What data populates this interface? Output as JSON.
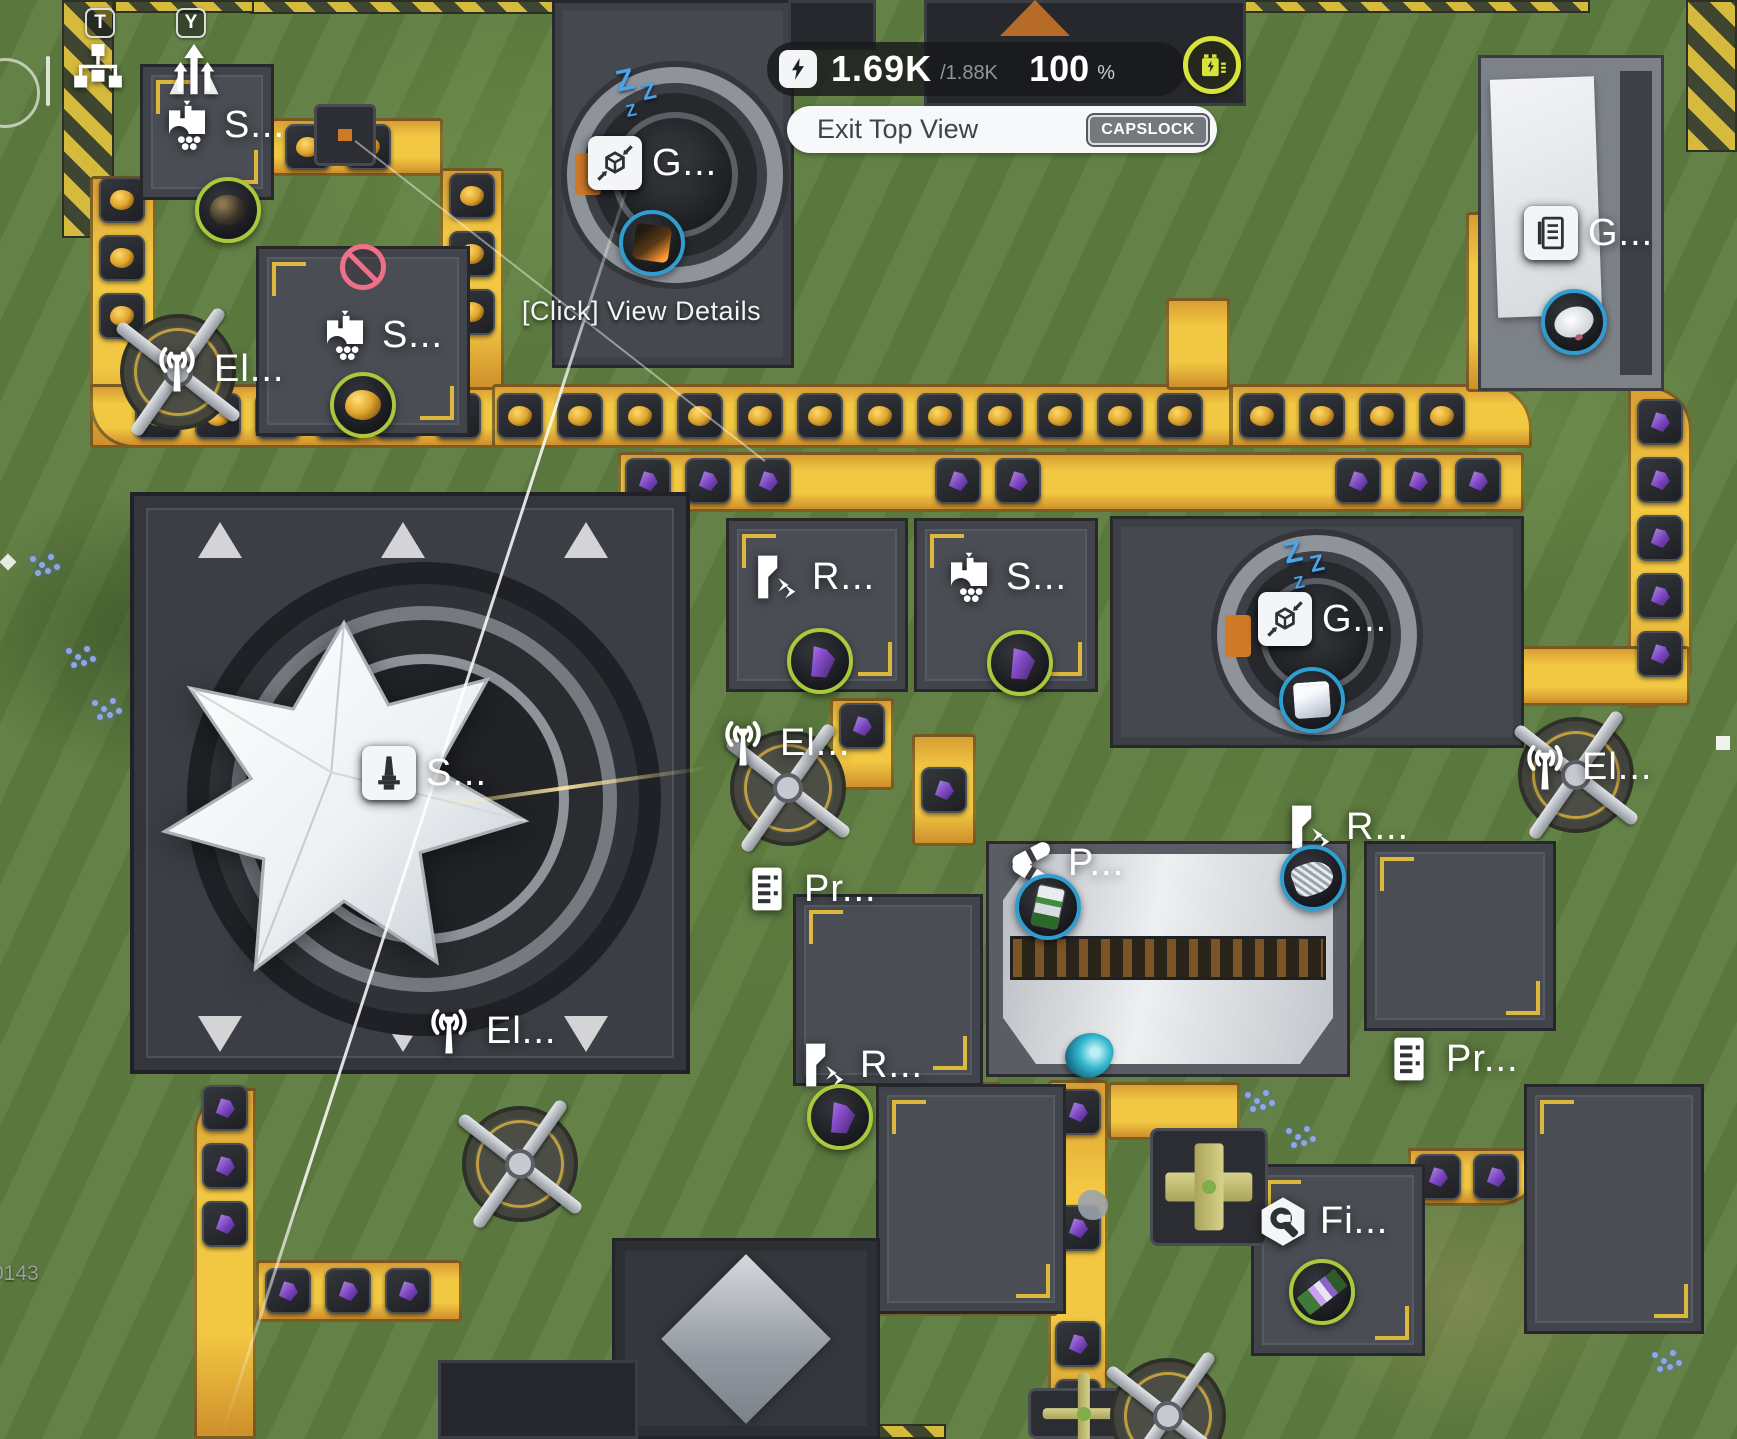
{
  "hud": {
    "keybinds": [
      {
        "key": "T",
        "icon": "org-chart-icon"
      },
      {
        "key": "Y",
        "icon": "ascend-icon"
      }
    ],
    "power": {
      "icon": "lightning-icon",
      "current": "1.69K",
      "capacity": "/1.88K",
      "percent": "100",
      "percent_symbol": "%",
      "battery_icon": "battery-icon",
      "accent_color": "#d8e43c"
    },
    "exit_button": {
      "label": "Exit Top View",
      "keybind": "CAPSLOCK"
    },
    "tooltip": "[Click] View Details",
    "version": "0143"
  },
  "colors": {
    "belt_yellow": "#f2c843",
    "ring_green": "#a9c83b",
    "ring_blue": "#2f9dd0",
    "sleep_blue": "#4aa5e8",
    "blocked_red": "#ef7088"
  },
  "buildings": [
    {
      "id": "storehouse-top-left",
      "label": "S...",
      "icon": "silo-icon",
      "lx": 160,
      "ly": 98,
      "item": {
        "name": "dark-ore",
        "ring": "green",
        "cx": 228,
        "cy": 210
      }
    },
    {
      "id": "storehouse-blocked",
      "label": "S...",
      "icon": "silo-icon",
      "lx": 318,
      "ly": 308,
      "blocked": {
        "cx": 363,
        "cy": 267
      },
      "item": {
        "name": "gold-ore",
        "ring": "green",
        "cx": 363,
        "cy": 405
      }
    },
    {
      "id": "pylon-left",
      "label": "El...",
      "icon": "antenna-icon",
      "lx": 150,
      "ly": 342
    },
    {
      "id": "grinder-top",
      "label": "G...",
      "icon": "compress-cube-icon",
      "lx": 588,
      "ly": 136,
      "sleep": {
        "x": 616,
        "y": 66
      },
      "item": {
        "name": "orange-cube",
        "ring": "blue",
        "cx": 652,
        "cy": 243
      }
    },
    {
      "id": "depot-top-right",
      "label": "G...",
      "icon": "document-icon",
      "lx": 1524,
      "ly": 206,
      "item": {
        "name": "dish",
        "ring": "blue",
        "cx": 1574,
        "cy": 322
      }
    },
    {
      "id": "refiner-mid",
      "label": "R...",
      "icon": "refinery-icon",
      "lx": 748,
      "ly": 550,
      "item": {
        "name": "purple-crystal",
        "ring": "green",
        "cx": 820,
        "cy": 661
      }
    },
    {
      "id": "storehouse-mid",
      "label": "S...",
      "icon": "silo-icon",
      "lx": 942,
      "ly": 550,
      "item": {
        "name": "purple-crystal",
        "ring": "green",
        "cx": 1020,
        "cy": 663
      }
    },
    {
      "id": "grinder-mid",
      "label": "G...",
      "icon": "compress-cube-icon",
      "lx": 1258,
      "ly": 592,
      "sleep": {
        "x": 1284,
        "y": 538
      },
      "item": {
        "name": "white-cube",
        "ring": "blue",
        "cx": 1312,
        "cy": 700
      }
    },
    {
      "id": "pylon-mid-left",
      "label": "El...",
      "icon": "antenna-icon",
      "lx": 716,
      "ly": 716
    },
    {
      "id": "pylon-mid-right",
      "label": "El...",
      "icon": "antenna-icon",
      "lx": 1518,
      "ly": 740
    },
    {
      "id": "spire",
      "label": "S...",
      "icon": "tower-icon",
      "lx": 362,
      "ly": 746
    },
    {
      "id": "processor-left",
      "label": "Pr...",
      "icon": "rack-icon",
      "lx": 740,
      "ly": 862
    },
    {
      "id": "packer-center",
      "label": "P...",
      "icon": "capsules-icon",
      "lx": 1004,
      "ly": 836,
      "item": {
        "name": "battery-cell",
        "ring": "blue",
        "cx": 1048,
        "cy": 907
      }
    },
    {
      "id": "refiner-right",
      "label": "R...",
      "icon": "refinery-icon",
      "lx": 1282,
      "ly": 800,
      "item": {
        "name": "silver-coil",
        "ring": "blue",
        "cx": 1313,
        "cy": 878
      }
    },
    {
      "id": "pylon-bottom-left",
      "label": "El...",
      "icon": "antenna-icon",
      "lx": 422,
      "ly": 1004
    },
    {
      "id": "refiner-bottom",
      "label": "R...",
      "icon": "refinery-icon",
      "lx": 796,
      "ly": 1038,
      "item": {
        "name": "purple-crystal",
        "ring": "green",
        "cx": 840,
        "cy": 1117
      }
    },
    {
      "id": "fitter",
      "label": "Fi...",
      "icon": "wrench-icon",
      "lx": 1256,
      "ly": 1194,
      "item": {
        "name": "circuit-board",
        "ring": "green",
        "cx": 1322,
        "cy": 1292
      }
    },
    {
      "id": "processor-right",
      "label": "Pr...",
      "icon": "rack-icon",
      "lx": 1382,
      "ly": 1032
    }
  ],
  "world": {
    "platforms": [
      {
        "type": "plain",
        "x": 140,
        "y": 64,
        "w": 134,
        "h": 136
      },
      {
        "type": "box",
        "x": 314,
        "y": 104,
        "w": 62,
        "h": 62
      },
      {
        "type": "plain",
        "x": 256,
        "y": 246,
        "w": 214,
        "h": 190
      },
      {
        "type": "grinder",
        "x": 552,
        "y": 0,
        "w": 242,
        "h": 368,
        "ring": {
          "cx": 120,
          "cy": 172,
          "r": 108
        }
      },
      {
        "type": "dark",
        "x": 924,
        "y": 0,
        "w": 322,
        "h": 106
      },
      {
        "type": "dark",
        "x": 788,
        "y": 0,
        "w": 88,
        "h": 50
      },
      {
        "type": "light",
        "x": 1478,
        "y": 55,
        "w": 186,
        "h": 336
      },
      {
        "type": "spire",
        "x": 130,
        "y": 492,
        "w": 560,
        "h": 582
      },
      {
        "type": "plain",
        "x": 726,
        "y": 518,
        "w": 182,
        "h": 174
      },
      {
        "type": "plain",
        "x": 914,
        "y": 518,
        "w": 184,
        "h": 174
      },
      {
        "type": "grinder",
        "x": 1110,
        "y": 516,
        "w": 414,
        "h": 232,
        "ring": {
          "cx": 204,
          "cy": 116,
          "r": 100
        }
      },
      {
        "type": "plain",
        "x": 793,
        "y": 894,
        "w": 190,
        "h": 192
      },
      {
        "type": "long",
        "x": 986,
        "y": 841,
        "w": 364,
        "h": 236
      },
      {
        "type": "plain",
        "x": 1364,
        "y": 841,
        "w": 192,
        "h": 190
      },
      {
        "type": "plain",
        "x": 876,
        "y": 1084,
        "w": 190,
        "h": 230
      },
      {
        "type": "diamond",
        "x": 612,
        "y": 1238,
        "w": 268,
        "h": 201
      },
      {
        "type": "plain",
        "x": 1251,
        "y": 1164,
        "w": 174,
        "h": 192
      },
      {
        "type": "plain",
        "x": 1524,
        "y": 1084,
        "w": 180,
        "h": 250
      },
      {
        "type": "splitter",
        "x": 1150,
        "y": 1128,
        "w": 118,
        "h": 118
      },
      {
        "type": "splitter",
        "x": 1028,
        "y": 1388,
        "w": 112,
        "h": 51
      },
      {
        "type": "dark",
        "x": 438,
        "y": 1360,
        "w": 200,
        "h": 79
      }
    ],
    "belts": [
      {
        "x": 90,
        "y": 176,
        "w": 66,
        "h": 272
      },
      {
        "x": 90,
        "y": 384,
        "w": 414,
        "h": 64,
        "br": "0 0 0 44px"
      },
      {
        "x": 440,
        "y": 168,
        "w": 64,
        "h": 222
      },
      {
        "x": 492,
        "y": 384,
        "w": 740,
        "h": 64
      },
      {
        "x": 1166,
        "y": 298,
        "w": 64,
        "h": 92
      },
      {
        "x": 1230,
        "y": 384,
        "w": 302,
        "h": 64,
        "br": "0 44px 0 0"
      },
      {
        "x": 1466,
        "y": 212,
        "w": 64,
        "h": 180
      },
      {
        "x": 618,
        "y": 452,
        "w": 906,
        "h": 60
      },
      {
        "x": 1628,
        "y": 386,
        "w": 64,
        "h": 322,
        "br": "0 44px 44px 0"
      },
      {
        "x": 1430,
        "y": 646,
        "w": 260,
        "h": 60
      },
      {
        "x": 830,
        "y": 698,
        "w": 64,
        "h": 92
      },
      {
        "x": 912,
        "y": 734,
        "w": 64,
        "h": 112
      },
      {
        "x": 1048,
        "y": 1080,
        "w": 60,
        "h": 359
      },
      {
        "x": 1108,
        "y": 1082,
        "w": 132,
        "h": 58
      },
      {
        "x": 944,
        "y": 1082,
        "w": 58,
        "h": 180
      },
      {
        "x": 850,
        "y": 1256,
        "w": 208,
        "h": 60
      },
      {
        "x": 1408,
        "y": 1148,
        "w": 134,
        "h": 58,
        "br": "0 0 44px 0"
      },
      {
        "x": 194,
        "y": 1088,
        "w": 62,
        "h": 351,
        "br": "44px 0 0 0"
      },
      {
        "x": 256,
        "y": 1260,
        "w": 206,
        "h": 62
      },
      {
        "x": 448,
        "y": 1392,
        "w": 252,
        "h": 47
      },
      {
        "x": 271,
        "y": 118,
        "w": 172,
        "h": 58
      }
    ],
    "tiles": [
      [
        158,
        416,
        "gold"
      ],
      [
        218,
        416,
        "gold"
      ],
      [
        278,
        416,
        "gold"
      ],
      [
        338,
        416,
        "gold"
      ],
      [
        398,
        416,
        "gold"
      ],
      [
        458,
        416,
        "gold"
      ],
      [
        520,
        416,
        "gold"
      ],
      [
        580,
        416,
        "gold"
      ],
      [
        640,
        416,
        "gold"
      ],
      [
        700,
        416,
        "gold"
      ],
      [
        760,
        416,
        "gold"
      ],
      [
        820,
        416,
        "gold"
      ],
      [
        880,
        416,
        "gold"
      ],
      [
        940,
        416,
        "gold"
      ],
      [
        1000,
        416,
        "gold"
      ],
      [
        1060,
        416,
        "gold"
      ],
      [
        1120,
        416,
        "gold"
      ],
      [
        1180,
        416,
        "gold"
      ],
      [
        1262,
        416,
        "gold"
      ],
      [
        1322,
        416,
        "gold"
      ],
      [
        1382,
        416,
        "gold"
      ],
      [
        1442,
        416,
        "gold"
      ],
      [
        122,
        200,
        "gold"
      ],
      [
        122,
        258,
        "gold"
      ],
      [
        122,
        316,
        "gold"
      ],
      [
        472,
        196,
        "gold"
      ],
      [
        472,
        254,
        "gold"
      ],
      [
        472,
        312,
        "gold"
      ],
      [
        308,
        147,
        "gold"
      ],
      [
        368,
        147,
        "gold"
      ],
      [
        648,
        481,
        "purple"
      ],
      [
        708,
        481,
        "purple"
      ],
      [
        768,
        481,
        "purple"
      ],
      [
        958,
        481,
        "purple"
      ],
      [
        1018,
        481,
        "purple"
      ],
      [
        1358,
        481,
        "purple"
      ],
      [
        1418,
        481,
        "purple"
      ],
      [
        1478,
        481,
        "purple"
      ],
      [
        1660,
        422,
        "purple"
      ],
      [
        1660,
        480,
        "purple"
      ],
      [
        1660,
        538,
        "purple"
      ],
      [
        1660,
        596,
        "purple"
      ],
      [
        1660,
        654,
        "purple"
      ],
      [
        862,
        726,
        "purple"
      ],
      [
        944,
        790,
        "purple"
      ],
      [
        225,
        1108,
        "purple"
      ],
      [
        225,
        1166,
        "purple"
      ],
      [
        225,
        1224,
        "purple"
      ],
      [
        288,
        1291,
        "purple"
      ],
      [
        348,
        1291,
        "purple"
      ],
      [
        408,
        1291,
        "purple"
      ],
      [
        973,
        1112,
        "purple"
      ],
      [
        973,
        1170,
        "purple"
      ],
      [
        973,
        1228,
        "purple"
      ],
      [
        1078,
        1112,
        "purple"
      ],
      [
        1078,
        1228,
        "purple"
      ],
      [
        1078,
        1344,
        "purple"
      ],
      [
        1078,
        1402,
        "purple"
      ],
      [
        882,
        1286,
        "purple"
      ],
      [
        942,
        1286,
        "purple"
      ],
      [
        1438,
        1177,
        "purple"
      ],
      [
        1496,
        1177,
        "purple"
      ]
    ],
    "pylons": [
      {
        "cx": 178,
        "cy": 372
      },
      {
        "cx": 788,
        "cy": 788
      },
      {
        "cx": 1576,
        "cy": 775
      },
      {
        "cx": 520,
        "cy": 1164
      },
      {
        "cx": 1168,
        "cy": 1416
      }
    ],
    "hazards": [
      {
        "x": 250,
        "y": 0,
        "w": 440,
        "h": 14
      },
      {
        "x": 114,
        "y": 0,
        "w": 140,
        "h": 13
      },
      {
        "x": 1240,
        "y": 0,
        "w": 350,
        "h": 13
      },
      {
        "x": 62,
        "y": 0,
        "w": 52,
        "h": 238
      },
      {
        "x": 1686,
        "y": 0,
        "w": 51,
        "h": 152
      },
      {
        "x": 636,
        "y": 1424,
        "w": 310,
        "h": 15
      }
    ],
    "flowers": [
      {
        "x": 66,
        "y": 648
      },
      {
        "x": 92,
        "y": 700
      },
      {
        "x": 1245,
        "y": 1092
      },
      {
        "x": 1286,
        "y": 1128
      },
      {
        "x": 1652,
        "y": 1352
      },
      {
        "x": 30,
        "y": 556
      }
    ]
  }
}
